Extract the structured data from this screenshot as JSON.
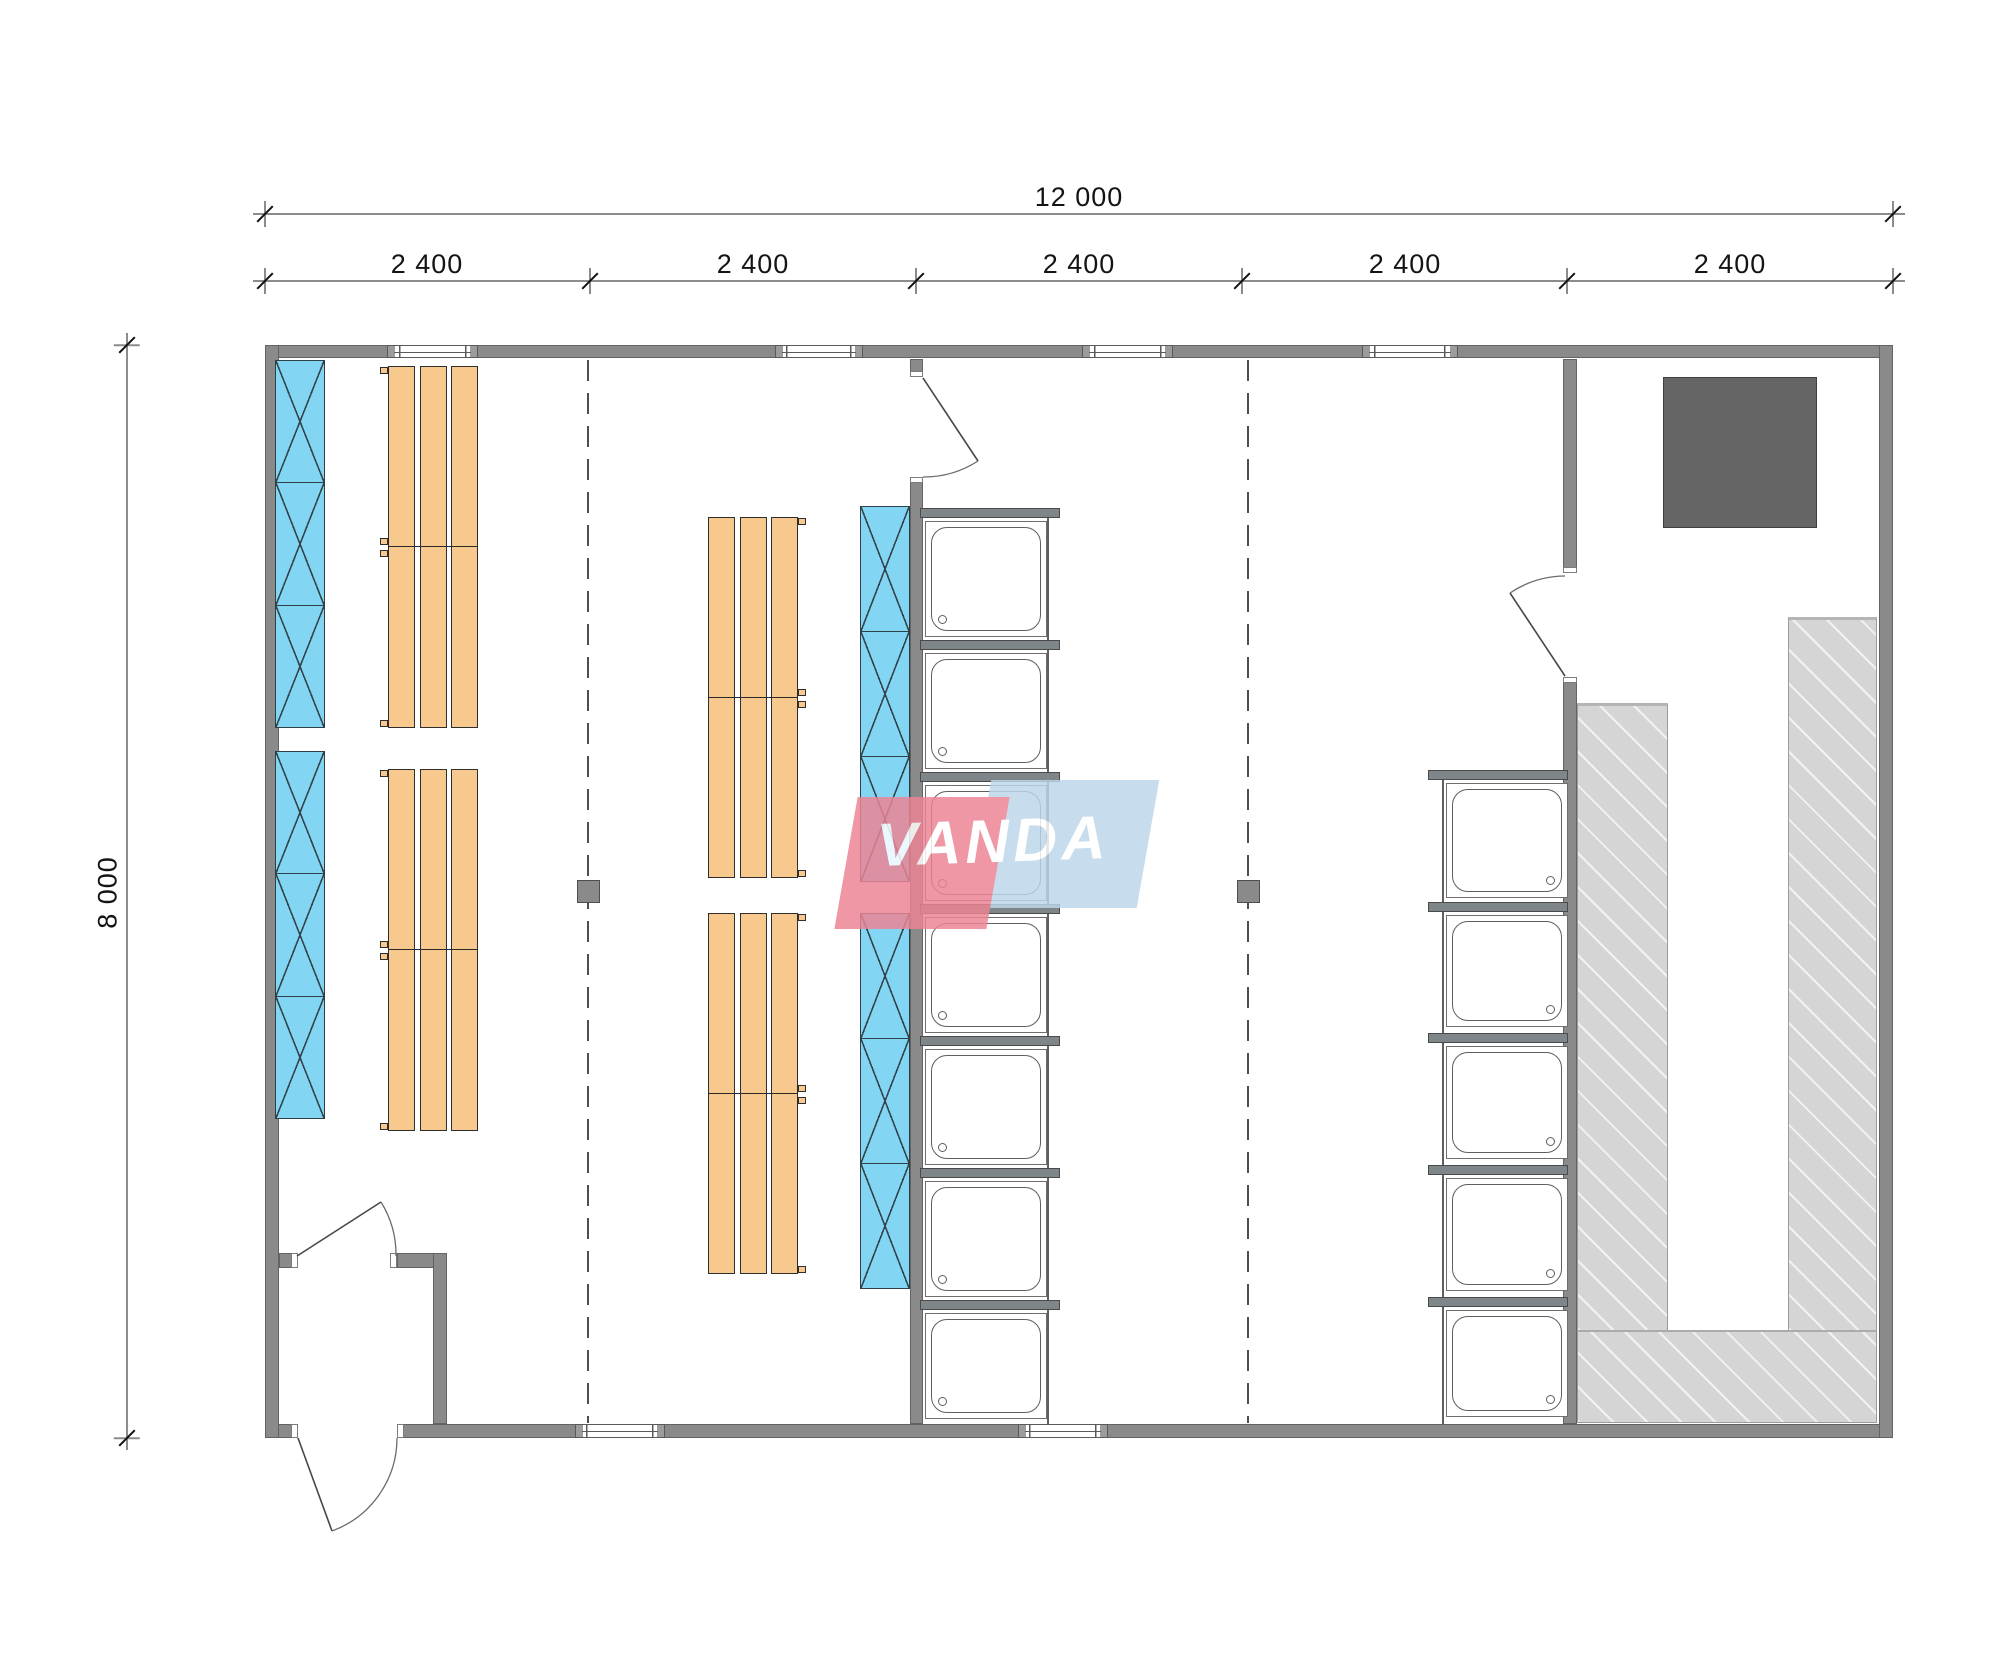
{
  "title": "Modular sauna building floor plan",
  "dimensions": {
    "overall_width_label": "12 000",
    "overall_depth_label": "8 000",
    "module_labels": [
      "2 400",
      "2 400",
      "2 400",
      "2 400",
      "2 400"
    ]
  },
  "watermark": {
    "brand_text": "VANDA",
    "pink_color": "#ec8494",
    "blue_color": "#bdd7eb"
  },
  "palette": {
    "wall_fill": "#8a8a8a",
    "locker_fill": "#82d6f3",
    "bench_fill": "#f7c98e",
    "sauna_bench_fill": "#d5d5d5",
    "stove_fill": "#656565",
    "dimension_text": "#141414"
  },
  "fixtures": {
    "windows_top_wall": 4,
    "windows_bottom_wall": 2,
    "doors": 4,
    "locker_strips": 4,
    "locker_sections_per_strip": 3,
    "bench_groups": 4,
    "shower_stalls_left_column": 7,
    "shower_stalls_right_column": 5,
    "structural_columns": 2,
    "sauna_stoves": 1
  }
}
